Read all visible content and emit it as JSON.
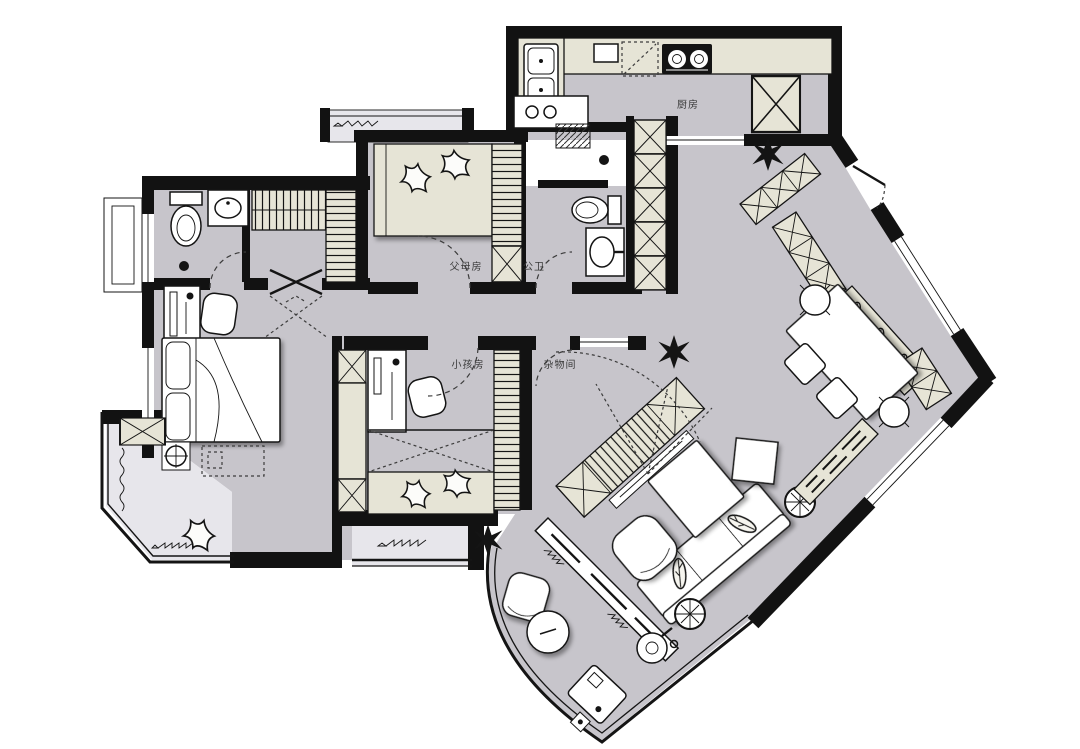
{
  "plan": {
    "type": "apartment-floor-plan",
    "rooms": {
      "kitchen": {
        "label": "厨房"
      },
      "parents_bedroom": {
        "label": "父母房"
      },
      "guest_bathroom": {
        "label": "公卫"
      },
      "kids_bedroom": {
        "label": "小孩房"
      },
      "storage_room": {
        "label": "杂物间"
      }
    },
    "colors": {
      "wall": "#121212",
      "floor": "#c7c5cb",
      "floor_light": "#e7e6eb",
      "cabinet": "#e6e4d6",
      "furniture": "#ffffff",
      "background": "#ffffff",
      "label_text": "#3a3a3a"
    }
  }
}
